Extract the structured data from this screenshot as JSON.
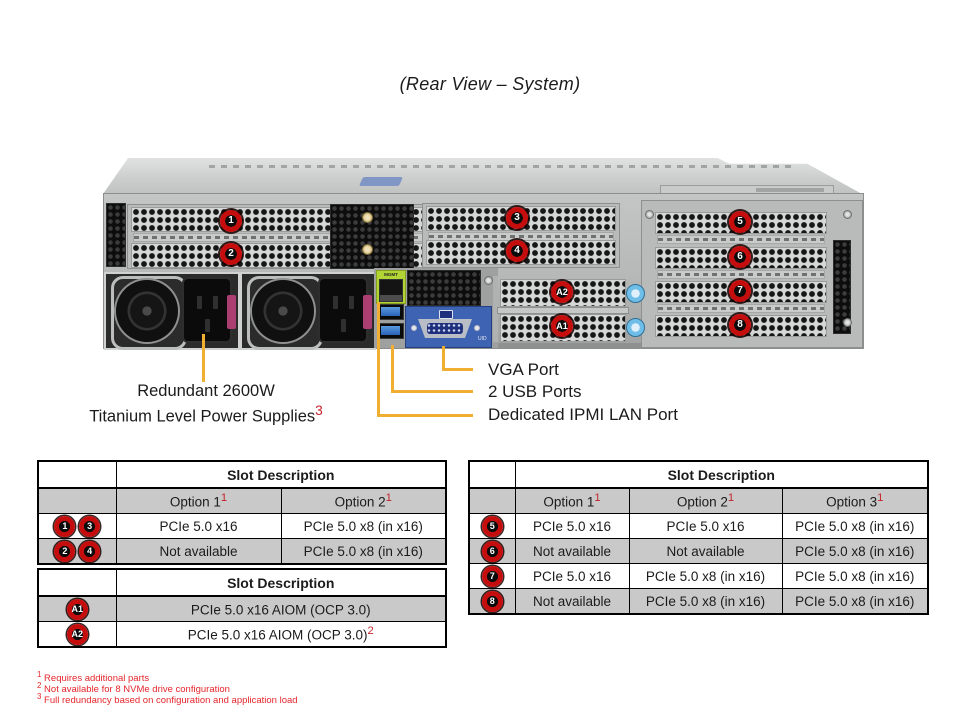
{
  "title": "(Rear View – System)",
  "server": {
    "mgmt_label": "MGMT",
    "uid_label": "UID",
    "badges": {
      "b1": "1",
      "b2": "2",
      "b3": "3",
      "b4": "4",
      "b5": "5",
      "b6": "6",
      "b7": "7",
      "b8": "8",
      "a1": "A1",
      "a2": "A2"
    }
  },
  "callouts": {
    "psu_line1": "Redundant 2600W",
    "psu_line2": "Titanium Level Power Supplies",
    "psu_sup": "3",
    "vga": "VGA Port",
    "usb": "2 USB Ports",
    "ipmi": "Dedicated IPMI LAN Port"
  },
  "tables": {
    "left_top": {
      "header": "Slot Description",
      "options": [
        {
          "text": "Option 1",
          "sup": "1"
        },
        {
          "text": "Option 2",
          "sup": "1"
        }
      ],
      "rows": [
        {
          "badges": [
            "1",
            "3"
          ],
          "cells": [
            "PCIe 5.0 x16",
            "PCIe 5.0 x8 (in x16)"
          ]
        },
        {
          "badges": [
            "2",
            "4"
          ],
          "cells": [
            "Not available",
            "PCIe 5.0 x8 (in x16)"
          ]
        }
      ]
    },
    "left_bottom": {
      "header": "Slot Description",
      "rows": [
        {
          "badge": "A1",
          "text": "PCIe 5.0 x16 AIOM (OCP 3.0)",
          "sup": ""
        },
        {
          "badge": "A2",
          "text": "PCIe 5.0 x16 AIOM (OCP 3.0)",
          "sup": "2"
        }
      ]
    },
    "right": {
      "header": "Slot Description",
      "options": [
        {
          "text": "Option 1",
          "sup": "1"
        },
        {
          "text": "Option 2",
          "sup": "1"
        },
        {
          "text": "Option 3",
          "sup": "1"
        }
      ],
      "rows": [
        {
          "badge": "5",
          "cells": [
            "PCIe 5.0 x16",
            "PCIe 5.0 x16",
            "PCIe 5.0 x8 (in x16)"
          ]
        },
        {
          "badge": "6",
          "cells": [
            "Not available",
            "Not available",
            "PCIe 5.0 x8 (in x16)"
          ]
        },
        {
          "badge": "7",
          "cells": [
            "PCIe 5.0 x16",
            "PCIe 5.0 x8 (in x16)",
            "PCIe 5.0 x8 (in x16)"
          ]
        },
        {
          "badge": "8",
          "cells": [
            "Not available",
            "PCIe 5.0 x8 (in x16)",
            "PCIe 5.0 x8 (in x16)"
          ]
        }
      ]
    }
  },
  "footnotes": [
    {
      "sup": "1",
      "text": "Requires additional parts"
    },
    {
      "sup": "2",
      "text": "Not available for 8 NVMe drive configuration"
    },
    {
      "sup": "3",
      "text": "Full redundancy based on configuration and application load"
    }
  ],
  "colors": {
    "callout_line": "#F0AE33",
    "badge_red": "#C60D0D",
    "table_shade": "#C9C9C9",
    "footnote_red": "#E4252B",
    "mgmt_green": "#B2D435",
    "usb_blue": "#2F6FC4",
    "vga_blue": "#3E63B2",
    "psu_clip_pink": "#AC3F72",
    "thumbscrew_blue": "#6FBEE8"
  }
}
